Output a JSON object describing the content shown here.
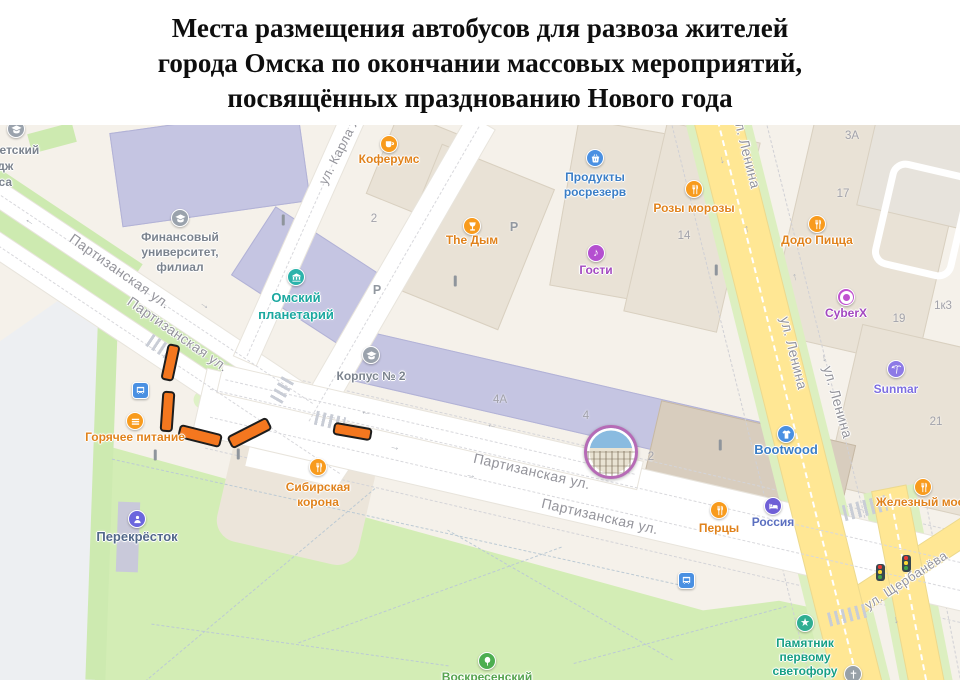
{
  "title": {
    "lines": [
      "Места размещения автобусов для развоза жителей",
      "города Омска по окончании массовых мероприятий,",
      "посвящённых празднованию Нового года"
    ]
  },
  "palette": {
    "bus_marker_orange": "#f4771f",
    "bus_marker_outline": "#1d1d1d",
    "road_yellow": "#ffe794",
    "road_white": "#ffffff",
    "map_background": "#f5f1ea",
    "park_green": "#d3edb5",
    "building_violet": "#c5c5e2",
    "building_beige": "#e9e2d6",
    "poi_food_orange": "#f89b1d",
    "poi_shop_blue": "#4a90e2",
    "poi_leisure_purple": "#b44fd0",
    "poi_museum_teal": "#2bb3ab",
    "photo_ring_purple": "#b66bb6"
  },
  "map": {
    "street_labels": [
      {
        "text": "Партизанская ул.",
        "x": 120,
        "y": 146,
        "rot": 35,
        "fs": 14
      },
      {
        "text": "Партизанская ул.",
        "x": 178,
        "y": 209,
        "rot": 35,
        "fs": 14
      },
      {
        "text": "Партизанская ул.",
        "x": 532,
        "y": 346,
        "rot": 13,
        "fs": 14
      },
      {
        "text": "Партизанская ул.",
        "x": 600,
        "y": 391,
        "rot": 13,
        "fs": 14
      },
      {
        "text": "ул. Ленина",
        "x": 747,
        "y": 27,
        "rot": 76,
        "fs": 14
      },
      {
        "text": "ул. Ленина",
        "x": 794,
        "y": 228,
        "rot": 76,
        "fs": 14
      },
      {
        "text": "ул. Ленина",
        "x": 838,
        "y": 277,
        "rot": 74,
        "fs": 14
      },
      {
        "text": "ул. Щербанёва",
        "x": 906,
        "y": 455,
        "rot": -33,
        "fs": 13
      },
      {
        "text": "ул. Карла Либкнехта",
        "x": 352,
        "y": 0,
        "rot": -63,
        "fs": 13
      }
    ],
    "building_numbers": [
      {
        "text": "2",
        "x": 374,
        "y": 94
      },
      {
        "text": "2",
        "x": 651,
        "y": 332
      },
      {
        "text": "4А",
        "x": 500,
        "y": 275
      },
      {
        "text": "4",
        "x": 586,
        "y": 291
      },
      {
        "text": "17",
        "x": 843,
        "y": 69
      },
      {
        "text": "14",
        "x": 684,
        "y": 111
      },
      {
        "text": "19",
        "x": 899,
        "y": 194
      },
      {
        "text": "1к3",
        "x": 943,
        "y": 181
      },
      {
        "text": "21",
        "x": 936,
        "y": 297
      },
      {
        "text": "3А",
        "x": 852,
        "y": 11
      }
    ],
    "pois": [
      {
        "name": "koferums",
        "icon": "coffee",
        "color": "#f89b1d",
        "label_color": "#e0821c",
        "x": 389,
        "y": 19,
        "ly": 27,
        "lines": [
          "Коферумс"
        ]
      },
      {
        "name": "the-dym",
        "icon": "hookah",
        "color": "#f89b1d",
        "label_color": "#e0821c",
        "x": 472,
        "y": 101,
        "ly": 108,
        "lines": [
          "The Дым"
        ]
      },
      {
        "name": "produkty-rosrezerv",
        "icon": "basket",
        "color": "#4a90e2",
        "label_color": "#3b7ec6",
        "x": 595,
        "y": 33,
        "ly": 45,
        "lh": 15,
        "lines": [
          "Продукты",
          "росрезерв"
        ]
      },
      {
        "name": "rozy-morozy",
        "icon": "food",
        "color": "#f89b1d",
        "label_color": "#e0821c",
        "x": 694,
        "y": 64,
        "ly": 76,
        "lines": [
          "Розы морозы"
        ]
      },
      {
        "name": "dodo-pizza",
        "icon": "food",
        "color": "#f89b1d",
        "label_color": "#e0821c",
        "x": 817,
        "y": 99,
        "ly": 108,
        "lines": [
          "Додо Пицца"
        ]
      },
      {
        "name": "gosti",
        "icon": "music",
        "color": "#b44fd0",
        "label_color": "#a348c0",
        "x": 596,
        "y": 128,
        "ly": 138,
        "lines": [
          "Гости"
        ]
      },
      {
        "name": "cyberx",
        "icon": "dot",
        "color": "#c052d0",
        "label_color": "#a348c0",
        "x": 846,
        "y": 172,
        "ly": 181,
        "lines": [
          "CyberX"
        ]
      },
      {
        "name": "sunmar",
        "icon": "palm",
        "color": "#8d7ae6",
        "label_color": "#7d6ee0",
        "x": 896,
        "y": 244,
        "ly": 257,
        "lines": [
          "Sunmar"
        ]
      },
      {
        "name": "omsky-planetariy",
        "icon": "museum",
        "color": "#2bb3ab",
        "label_color": "#1ba8a0",
        "x": 296,
        "y": 152,
        "ly": 164,
        "lh": 17,
        "fs": 13,
        "lines": [
          "Омский",
          "планетарий"
        ]
      },
      {
        "name": "korpus-2",
        "icon": "edu",
        "color": "#9aa2ac",
        "label_color": "#7b838e",
        "x": 371,
        "y": 230,
        "ly": 244,
        "lines": [
          "Корпус № 2"
        ]
      },
      {
        "name": "finansovy-universitet",
        "icon": "edu",
        "color": "#9aa2ac",
        "label_color": "#7b838e",
        "x": 180,
        "y": 93,
        "ly": 105,
        "lh": 15,
        "lines": [
          "Финансовый",
          "университет,",
          "филиал"
        ]
      },
      {
        "name": "kolledzh-biznesa",
        "icon": "edu",
        "color": "#9aa2ac",
        "label_color": "#7b838e",
        "x": 16,
        "y": 4,
        "lx": -12,
        "ly": 17,
        "lh": 16,
        "lines": [
          "Университетский",
          "колледж",
          "бизнеса"
        ]
      },
      {
        "name": "sibirskaya-korona",
        "icon": "food",
        "color": "#f89b1d",
        "label_color": "#e0821c",
        "x": 318,
        "y": 342,
        "ly": 355,
        "lh": 15,
        "lines": [
          "Сибирская",
          "корона"
        ]
      },
      {
        "name": "goryachee-pitanie",
        "icon": "burger",
        "color": "#f89b1d",
        "label_color": "#e0821c",
        "x": 135,
        "y": 296,
        "ly": 305,
        "lines": [
          "Горячее питание"
        ]
      },
      {
        "name": "perekrestok",
        "icon": "person",
        "color": "#6b66dd",
        "label_color": "#52688a",
        "x": 137,
        "y": 394,
        "ly": 404,
        "fs": 13,
        "lines": [
          "Перекрёсток"
        ]
      },
      {
        "name": "pertsy",
        "icon": "food",
        "color": "#f89b1d",
        "label_color": "#e0821c",
        "x": 719,
        "y": 385,
        "ly": 396,
        "lines": [
          "Перцы"
        ]
      },
      {
        "name": "rossiya",
        "icon": "bed",
        "color": "#6f5fd6",
        "label_color": "#5b6fc0",
        "x": 773,
        "y": 381,
        "ly": 390,
        "lines": [
          "Россия"
        ]
      },
      {
        "name": "bootwood",
        "icon": "tshirt",
        "color": "#4a90e2",
        "label_color": "#3b7ec6",
        "x": 786,
        "y": 309,
        "ly": 317,
        "fs": 13,
        "lines": [
          "Bootwood"
        ]
      },
      {
        "name": "zhelezny-most",
        "icon": "food",
        "color": "#f89b1d",
        "label_color": "#e0821c",
        "x": 923,
        "y": 362,
        "ly": 370,
        "lines": [
          "Железный мост"
        ]
      },
      {
        "name": "pamyatnik-pervomu-svetoforu",
        "icon": "star",
        "color": "#2fae92",
        "label_color": "#169f83",
        "x": 805,
        "y": 498,
        "ly": 511,
        "lh": 14,
        "lines": [
          "Памятник",
          "первому",
          "светофору"
        ]
      },
      {
        "name": "voskresensky",
        "icon": "tree",
        "color": "#4cae50",
        "label_color": "#56a44e",
        "x": 487,
        "y": 536,
        "ly": 545,
        "lines": [
          "Воскресенский"
        ]
      },
      {
        "name": "church",
        "icon": "cross",
        "color": "#98a1a8",
        "label_color": "#98a1a8",
        "x": 853,
        "y": 549,
        "lines": []
      }
    ],
    "bus_markers": [
      {
        "x": 170,
        "y": 237,
        "w": 13,
        "h": 37,
        "rot": 12
      },
      {
        "x": 167,
        "y": 286,
        "w": 13,
        "h": 41,
        "rot": 4
      },
      {
        "x": 200,
        "y": 311,
        "w": 44,
        "h": 14,
        "rot": 14
      },
      {
        "x": 249,
        "y": 308,
        "w": 45,
        "h": 14,
        "rot": -27
      },
      {
        "x": 352,
        "y": 306,
        "w": 39,
        "h": 13,
        "rot": 10
      }
    ],
    "bus_stops": [
      {
        "x": 140,
        "y": 265
      },
      {
        "x": 686,
        "y": 455
      }
    ],
    "traffic_lights": [
      {
        "x": 880,
        "y": 447
      },
      {
        "x": 906,
        "y": 438
      }
    ],
    "parking_signs": [
      {
        "x": 514,
        "y": 102,
        "text": "P"
      },
      {
        "x": 377,
        "y": 165,
        "text": "P"
      }
    ],
    "poles": [
      {
        "x": 283,
        "y": 95
      },
      {
        "x": 455,
        "y": 156
      },
      {
        "x": 155,
        "y": 330
      },
      {
        "x": 238,
        "y": 329
      },
      {
        "x": 720,
        "y": 320
      },
      {
        "x": 716,
        "y": 145
      }
    ],
    "arrows": [
      {
        "x": 30,
        "y": 96,
        "rot": 34,
        "ch": "←"
      },
      {
        "x": 205,
        "y": 180,
        "rot": 34,
        "ch": "→"
      },
      {
        "x": 366,
        "y": 287,
        "rot": 13,
        "ch": "←"
      },
      {
        "x": 395,
        "y": 322,
        "rot": 13,
        "ch": "→"
      },
      {
        "x": 492,
        "y": 300,
        "rot": 13,
        "ch": "←"
      },
      {
        "x": 471,
        "y": 350,
        "rot": 13,
        "ch": "→"
      },
      {
        "x": 722,
        "y": 35,
        "rot": -14,
        "ch": "↓"
      },
      {
        "x": 747,
        "y": 104,
        "rot": -14,
        "ch": "↑"
      },
      {
        "x": 795,
        "y": 152,
        "rot": -14,
        "ch": "↑"
      },
      {
        "x": 824,
        "y": 233,
        "rot": -14,
        "ch": "↓"
      },
      {
        "x": 896,
        "y": 495,
        "rot": -11,
        "ch": "↓"
      }
    ],
    "photo_marker": {
      "x": 608,
      "y": 324,
      "d": 48
    }
  }
}
